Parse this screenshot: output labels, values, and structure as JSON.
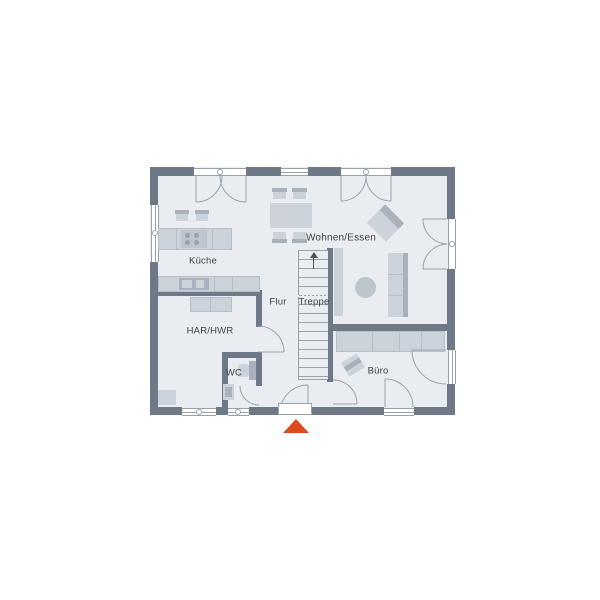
{
  "floorplan": {
    "rooms": {
      "kitchen": {
        "label": "Küche"
      },
      "living_dining": {
        "label": "Wohnen/Essen"
      },
      "hallway": {
        "label": "Flur"
      },
      "stairs": {
        "label": "Treppe"
      },
      "utility": {
        "label": "HAR/HWR"
      },
      "wc": {
        "label": "WC"
      },
      "office": {
        "label": "Büro"
      }
    },
    "colors": {
      "background": "#ffffff",
      "floor": "#e9edf2",
      "wall": "#6e7987",
      "furniture": "#cbd2d9",
      "furniture_dark": "#a9b2bc",
      "outline": "#98a2ad",
      "entrance_marker": "#dd4a1e",
      "label_text": "#3d424a"
    }
  }
}
